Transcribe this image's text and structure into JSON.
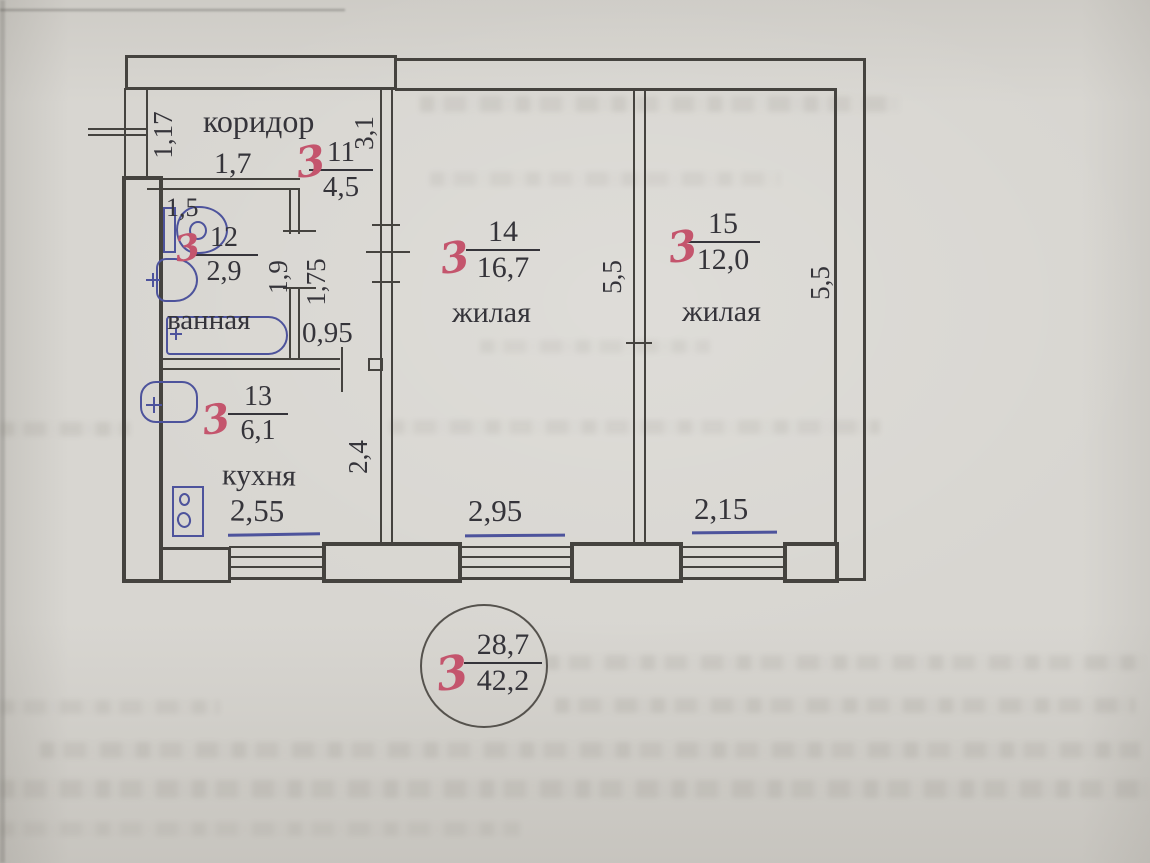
{
  "plan": {
    "rooms": {
      "corridor": {
        "red": "3",
        "num": "11",
        "area": "4,5",
        "label": "коридор"
      },
      "bathroom": {
        "red": "3",
        "num": "12",
        "area": "2,9",
        "label": "ванная"
      },
      "kitchen": {
        "red": "3",
        "num": "13",
        "area": "6,1",
        "label": "кухня"
      },
      "living1": {
        "red": "3",
        "num": "14",
        "area": "16,7",
        "label": "жилая"
      },
      "living2": {
        "red": "3",
        "num": "15",
        "area": "12,0",
        "label": "жилая"
      }
    },
    "dims": {
      "entry_width": "1,17",
      "corridor_width": "1,7",
      "corridor_length": "3,1",
      "wc_width": "1,5",
      "bath_length": "1,9",
      "hall_length": "1,75",
      "door_width": "0,95",
      "kitchen_width": "2,55",
      "kitchen_length": "2,4",
      "living1_width": "2,95",
      "living1_length": "5,5",
      "living2_width": "2,15",
      "living2_length": "5,5"
    },
    "stamp": {
      "red": "3",
      "numerator": "28,7",
      "denominator": "42,2"
    },
    "colors": {
      "paper": "#d8d6d1",
      "wall_line": "#45433f",
      "blue_ink": "#4d539c",
      "red_pen": "#c4556d"
    }
  }
}
